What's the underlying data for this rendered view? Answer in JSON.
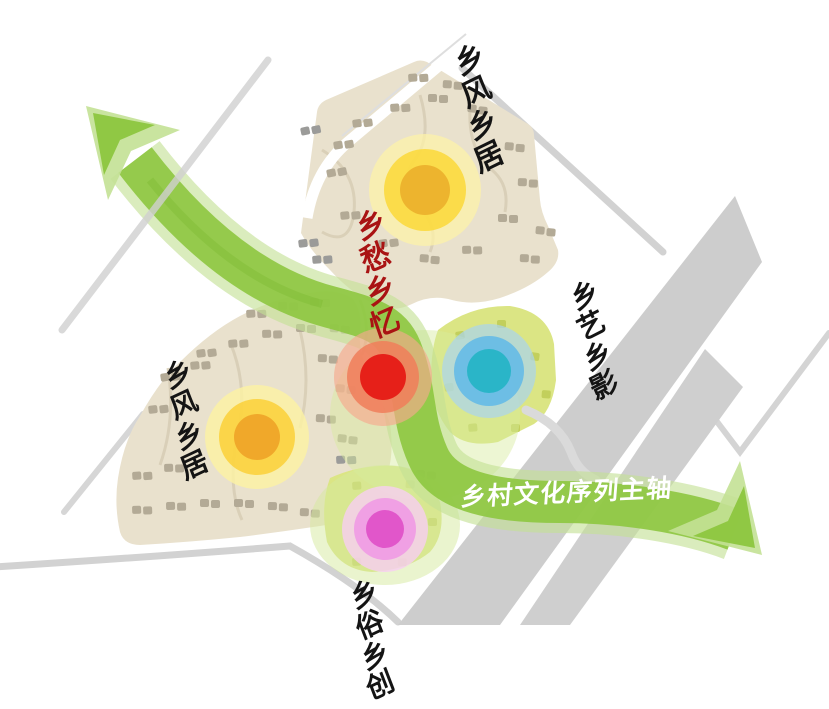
{
  "diagram": {
    "axis_label": "乡村文化序列主轴",
    "center_label": "乡愁乡忆",
    "zones": [
      {
        "id": "northeast",
        "label": "乡风乡居"
      },
      {
        "id": "east",
        "label": "乡艺乡影"
      },
      {
        "id": "west",
        "label": "乡风乡居"
      },
      {
        "id": "south",
        "label": "乡俗乡创"
      }
    ]
  },
  "colors": {
    "background": "#ffffff",
    "axis_band": "#8dc63f",
    "axis_band_light": "#c3e195",
    "axis_band_fold": "#79b82e",
    "center_label_red": "#a91313",
    "zone_label_black": "#141414",
    "axis_label_white": "#ffffff",
    "road_line_gray": "#d2d2d2",
    "road_band_gray": "#cdcdcd",
    "parcel_tan": "#e9e1cd",
    "parcel_path_tan": "#d8ceb6",
    "parcel_green": "#dbe584",
    "green_wash": "#d6ea9e",
    "building_tan": "#b3aa96",
    "building_gray": "#9b9b99",
    "building_green": "#c2cf5c",
    "white_path": "#ffffff"
  },
  "hotspots": [
    {
      "id": "north-node",
      "core": "#edb42e",
      "mid": "#fbd93e",
      "glow": "#fcf1a8"
    },
    {
      "id": "west-node",
      "core": "#f0a82a",
      "mid": "#fbd23e",
      "glow": "#fdf2a2"
    },
    {
      "id": "center-node",
      "core": "#e62019",
      "mid": "#f07e5a",
      "glow": "#f6a98e"
    },
    {
      "id": "east-node",
      "core": "#2ab5c8",
      "mid": "#5fb8e8",
      "glow": "#a9d4f0"
    },
    {
      "id": "south-node",
      "core": "#e156ca",
      "mid": "#f09ae4",
      "glow": "#f8cef2"
    }
  ],
  "map": {
    "clusters_tan": [
      [
        408,
        74,
        -4
      ],
      [
        443,
        80,
        3
      ],
      [
        352,
        120,
        -8
      ],
      [
        390,
        104,
        -4
      ],
      [
        428,
        94,
        0
      ],
      [
        468,
        104,
        6
      ],
      [
        333,
        142,
        -10
      ],
      [
        326,
        170,
        -12
      ],
      [
        505,
        142,
        4
      ],
      [
        518,
        178,
        2
      ],
      [
        340,
        212,
        -6
      ],
      [
        378,
        240,
        -8
      ],
      [
        420,
        254,
        4
      ],
      [
        462,
        246,
        -2
      ],
      [
        498,
        214,
        0
      ],
      [
        536,
        226,
        5
      ],
      [
        520,
        254,
        2
      ],
      [
        246,
        310,
        -4
      ],
      [
        278,
        302,
        -2
      ],
      [
        310,
        298,
        0
      ],
      [
        196,
        350,
        -8
      ],
      [
        228,
        340,
        -5
      ],
      [
        262,
        330,
        -2
      ],
      [
        296,
        324,
        0
      ],
      [
        330,
        324,
        3
      ],
      [
        160,
        374,
        -9
      ],
      [
        190,
        362,
        -6
      ],
      [
        148,
        406,
        -7
      ],
      [
        318,
        354,
        2
      ],
      [
        336,
        384,
        4
      ],
      [
        316,
        414,
        2
      ],
      [
        338,
        434,
        5
      ],
      [
        132,
        472,
        -4
      ],
      [
        164,
        464,
        -2
      ],
      [
        132,
        506,
        -2
      ],
      [
        166,
        502,
        -1
      ],
      [
        200,
        499,
        0
      ],
      [
        234,
        499,
        0
      ],
      [
        268,
        502,
        1
      ],
      [
        300,
        508,
        2
      ],
      [
        330,
        516,
        3
      ]
    ],
    "clusters_gray": [
      [
        298,
        240,
        -8
      ],
      [
        312,
        256,
        -5
      ],
      [
        300,
        128,
        -12
      ],
      [
        416,
        470,
        2
      ],
      [
        404,
        490,
        5
      ],
      [
        336,
        456,
        -3
      ]
    ],
    "blocks_green": [
      [
        455,
        332,
        -8
      ],
      [
        497,
        320,
        0
      ],
      [
        531,
        352,
        8
      ],
      [
        542,
        390,
        4
      ],
      [
        511,
        424,
        0
      ],
      [
        468,
        424,
        -5
      ],
      [
        444,
        384,
        -8
      ],
      [
        352,
        482,
        -4
      ],
      [
        406,
        480,
        4
      ],
      [
        428,
        518,
        0
      ],
      [
        398,
        558,
        2
      ],
      [
        352,
        558,
        -3
      ]
    ]
  }
}
